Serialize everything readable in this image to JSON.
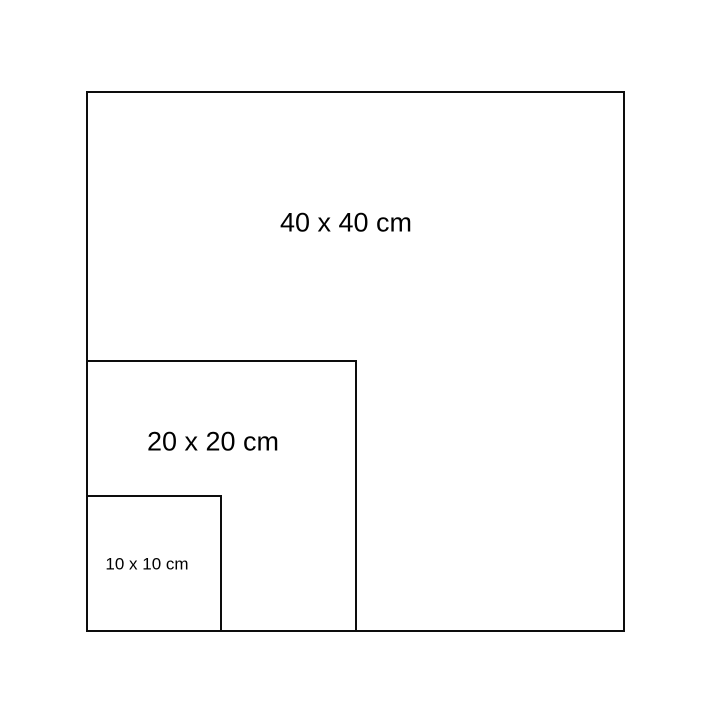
{
  "diagram": {
    "description": "Nested squares size comparison",
    "background_color": "#ffffff",
    "stroke_color": "#000000",
    "squares": [
      {
        "label": "40 x 40 cm",
        "width_cm": 40,
        "height_cm": 40
      },
      {
        "label": "20 x 20 cm",
        "width_cm": 20,
        "height_cm": 20
      },
      {
        "label": "10 x 10 cm",
        "width_cm": 10,
        "height_cm": 10
      }
    ]
  }
}
